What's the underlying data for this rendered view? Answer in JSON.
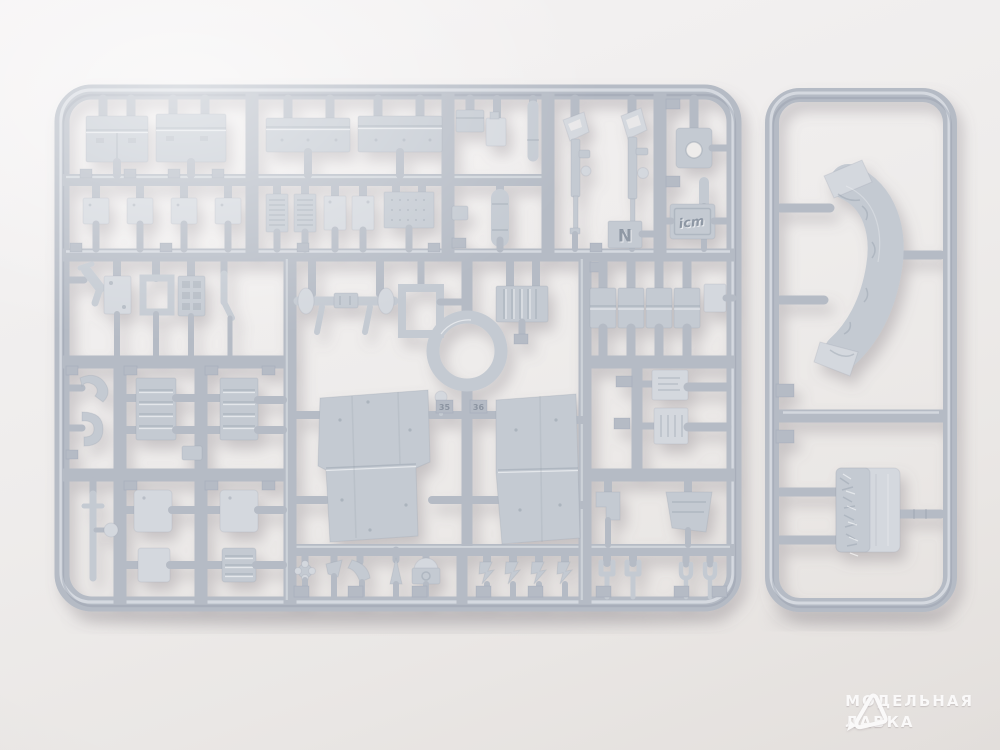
{
  "scene": {
    "subject": "plastic-model-kit-sprues-product-photo",
    "sprue_count": 2
  },
  "colors": {
    "bg-top": "#f5f3f4",
    "bg-mid": "#eeeceb",
    "bg-bottom": "#e3dfdc",
    "plastic": "#b5bbc5",
    "plastic-light": "#cdd2d9",
    "plastic-lighter": "#dde1e6",
    "plastic-dark": "#8f98a5",
    "part": "#c4cad2",
    "part-light": "#d4d8de",
    "shadow": "#8d8a90",
    "watermark": "#ffffff"
  },
  "labels": {
    "plate_letter": "N",
    "brand_plate": "icm",
    "tag_left": "35",
    "tag_right": "36"
  },
  "watermark": {
    "line1": "МОДЕЛЬНАЯ",
    "line2": "ЛАВКА"
  },
  "parts_legend": {
    "main_sprue": [
      "tool-boxes",
      "stowage-boxes",
      "access-panels",
      "radiator-plates",
      "rifles",
      "letter-plate",
      "brand-logo-plate",
      "tow-hooks",
      "axle-with-wheels",
      "square-frame",
      "louvered-boxes",
      "spare-ring",
      "fender-panels",
      "license-plates",
      "clamp-blocks",
      "small-fittings"
    ],
    "side_sprue": [
      "rolled-tarpaulin",
      "textured-bundle"
    ]
  }
}
